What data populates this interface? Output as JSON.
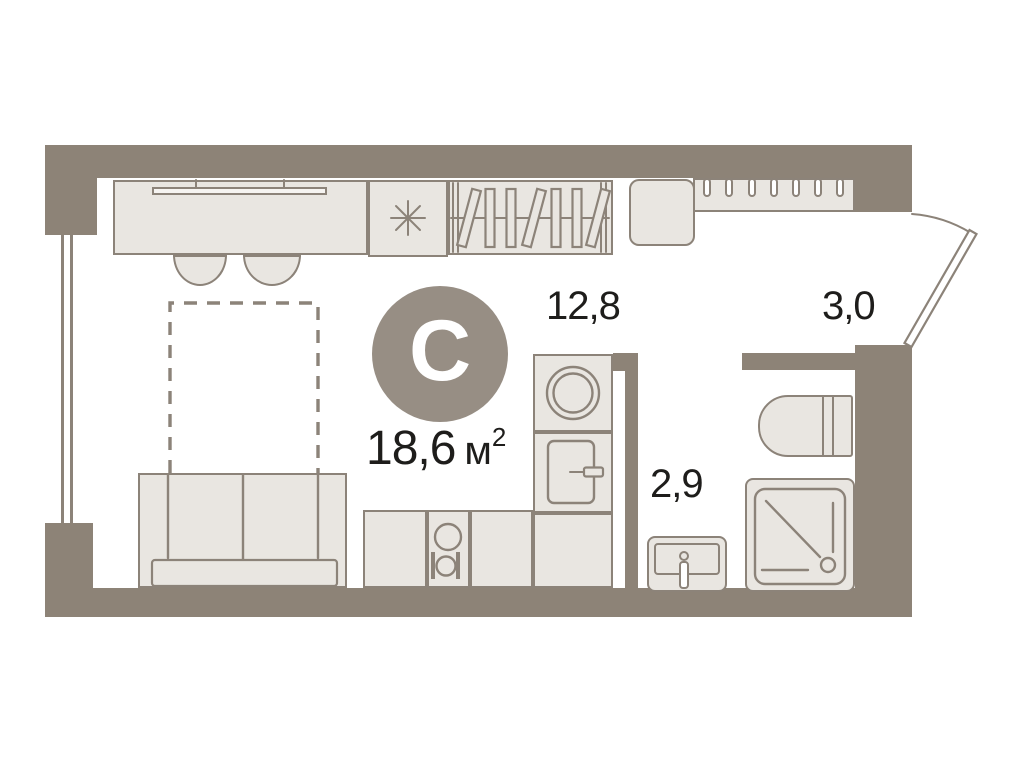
{
  "plan": {
    "type_badge": "С",
    "total_area": {
      "value": "18,6",
      "unit_base": "м",
      "unit_sup": "2"
    },
    "rooms": [
      {
        "id": "living-room",
        "area": "12,8"
      },
      {
        "id": "bathroom",
        "area": "2,9"
      },
      {
        "id": "hallway",
        "area": "3,0"
      }
    ]
  },
  "colors": {
    "wall": "#8d8377",
    "outline": "#8c8379",
    "furniture_fill": "#e9e6e1",
    "badge_bg": "#978e84",
    "badge_letter": "#ffffff",
    "text": "#1e1d1b",
    "background": "#ffffff"
  }
}
